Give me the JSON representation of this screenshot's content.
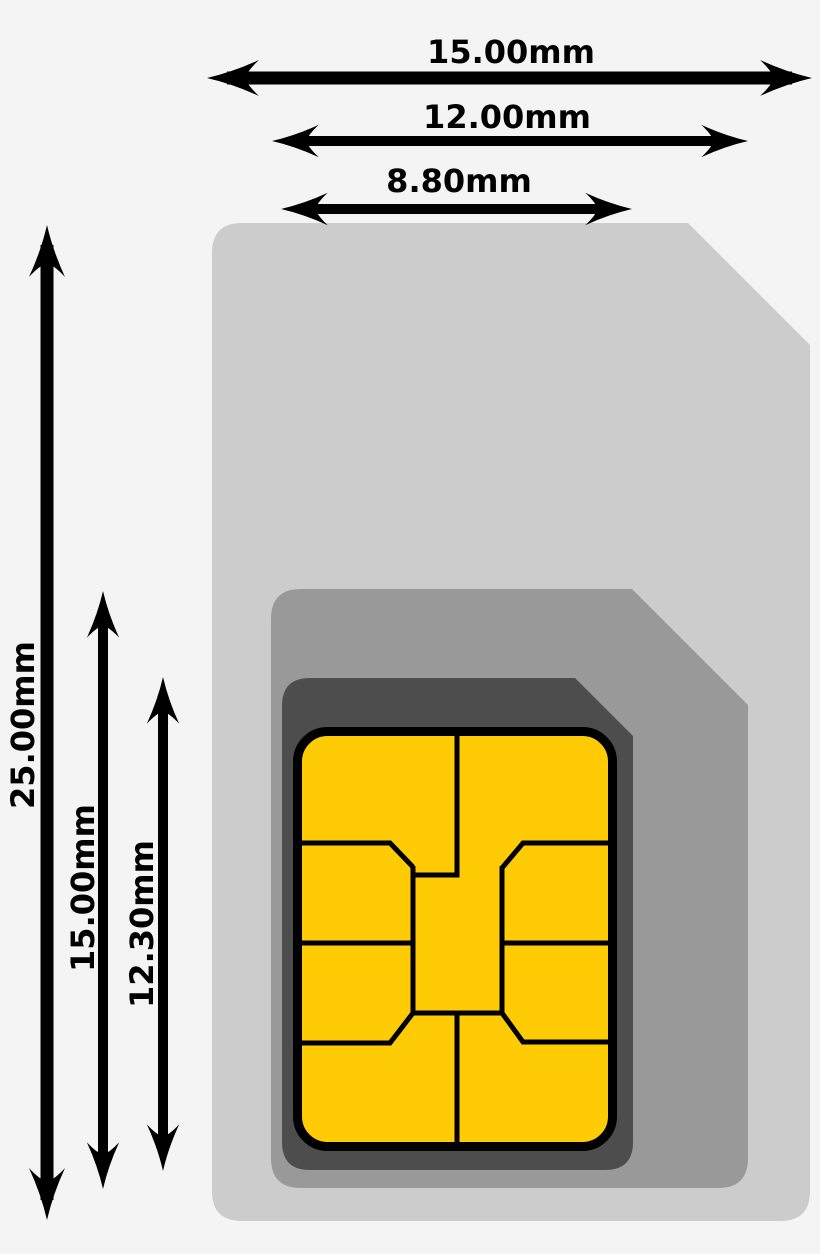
{
  "diagram": {
    "dimensions": {
      "mini": {
        "width": "15.00mm",
        "height": "25.00mm"
      },
      "micro": {
        "width": "12.00mm",
        "height": "15.00mm"
      },
      "nano": {
        "width": "8.80mm",
        "height": "12.30mm"
      }
    },
    "colors": {
      "background": "#f4f4f4",
      "mini_card": "#cccccc",
      "micro_card": "#999999",
      "nano_card": "#4d4d4d",
      "chip_fill": "#ffcb05",
      "chip_line": "#000000",
      "dimension": "#000000"
    }
  }
}
